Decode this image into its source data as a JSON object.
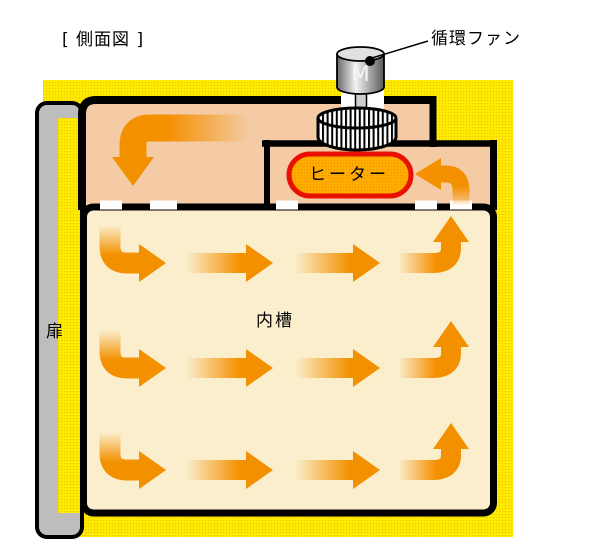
{
  "diagram": {
    "title": "[ 側面図 ]",
    "fan_label": "循環ファン",
    "motor_label": "M",
    "heater_label": "ヒーター",
    "chamber_label": "内槽",
    "door_label": "扉"
  },
  "colors": {
    "body_yellow": "#FFEC00",
    "duct_salmon": "#F5CBA6",
    "chamber_cream": "#FAEECD",
    "door_gray": "#BDBDBD",
    "arrow_orange": "#F39000",
    "heater_fill": "#FFAE00",
    "heater_border": "#E81000",
    "fan_metal_light": "#E0E0E0",
    "outline": "#000000"
  }
}
